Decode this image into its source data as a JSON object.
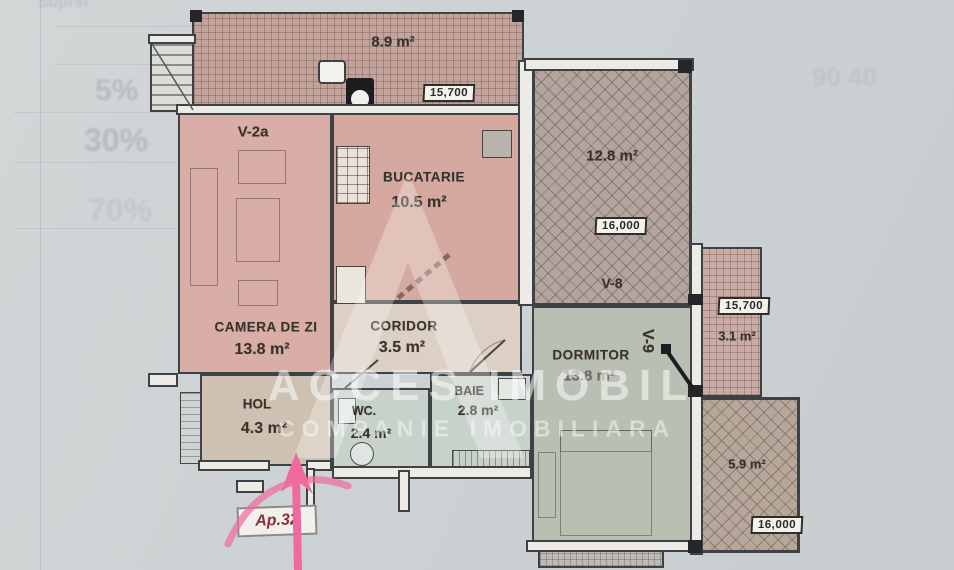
{
  "plan": {
    "rooms": {
      "living": {
        "name": "CAMERA DE ZI",
        "area": "13.8 m²",
        "window_label": "V-2a"
      },
      "kitchen": {
        "name": "BUCATARIE",
        "area": "10.5 m²"
      },
      "coridor": {
        "name": "CORIDOR",
        "area": "3.5 m²"
      },
      "dormitor": {
        "name": "DORMITOR",
        "area": "13.8 m²",
        "window_label": "V-9"
      },
      "hol": {
        "name": "HOL",
        "area": "4.3 m²"
      },
      "wc": {
        "name": "WC.",
        "area": "2.4 m²"
      },
      "baie": {
        "name": "BAIE",
        "area": "2.8 m²"
      }
    },
    "balconies": {
      "top": {
        "area": "8.9 m²",
        "dimension": "15,700"
      },
      "v8": {
        "area": "12.8 m²",
        "dimension": "16,000",
        "label": "V-8"
      },
      "right": {
        "area": "3.1 m²",
        "dimension": "15,700"
      },
      "bottom_right": {
        "area": "5.9 m²",
        "dimension": "16,000"
      }
    },
    "entrance_label": "Ap.32"
  },
  "watermark": {
    "company": "ACCES IMOBIL",
    "tagline": "COMPANIE IMOBILIARA"
  },
  "underlying_page": {
    "heading": "Supraf",
    "values": [
      "5%",
      "30%",
      "70%"
    ],
    "corner_note": "90 40"
  },
  "colors": {
    "paper": "#cdd2d4",
    "wall_line": "#3f4245",
    "living_fill": "#d9aea7",
    "kitchen_fill": "#d5a9a0",
    "balcony_top_fill": "#c3a49d",
    "v8_fill": "#b3a59d",
    "right_balcony_fill": "#c9aca5",
    "bottom_right_balcony_fill": "#b7a79b",
    "dormitor_fill": "#babfb4",
    "bath_fill": "#c7d2cb",
    "coridor_fill": "#dccfc4",
    "hol_fill": "#cfc1b1",
    "annotation_pink": "#ef6a9d",
    "entrance_text": "#8b2f38"
  }
}
